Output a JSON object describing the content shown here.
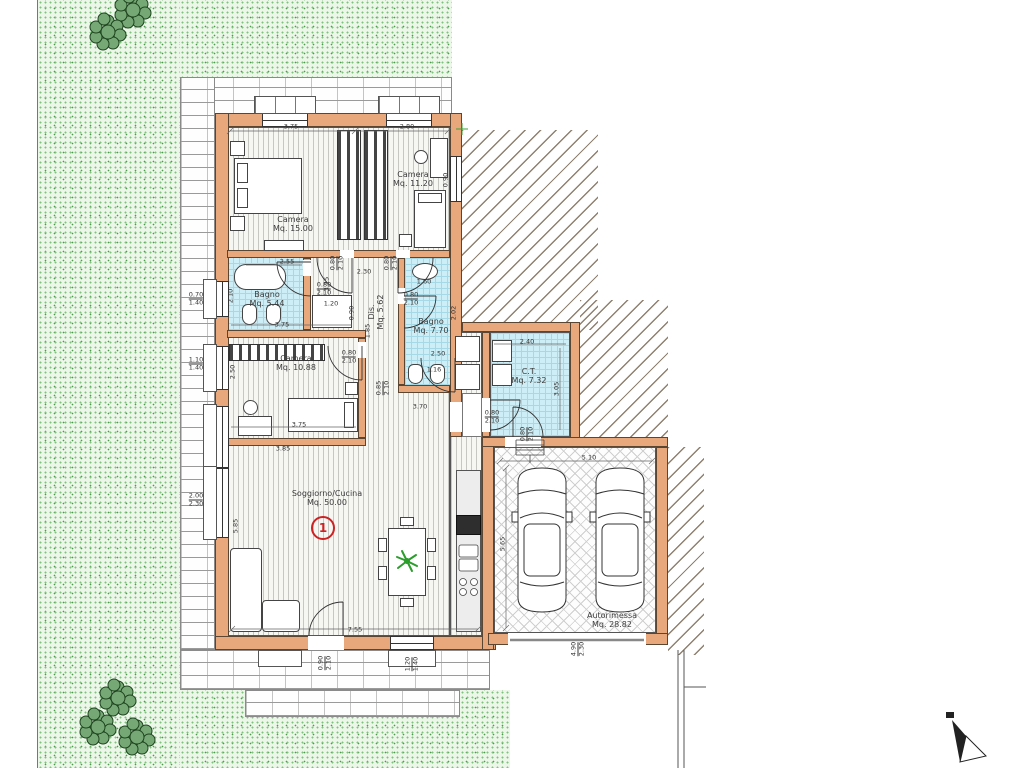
{
  "plan": {
    "unit_number": "1",
    "rooms": [
      {
        "id": "camera1",
        "label": "Camera",
        "area": "Mq. 15.00",
        "x": 293,
        "y": 224,
        "r": 0
      },
      {
        "id": "camera2",
        "label": "Camera",
        "area": "Mq. 11.20",
        "x": 413,
        "y": 179,
        "r": 0
      },
      {
        "id": "bagno1",
        "label": "Bagno",
        "area": "Mq. 5.44",
        "x": 267,
        "y": 299,
        "r": 0
      },
      {
        "id": "bagno2",
        "label": "Bagno",
        "area": "Mq. 7.70",
        "x": 431,
        "y": 326,
        "r": 0
      },
      {
        "id": "camera3",
        "label": "Camera",
        "area": "Mq. 10.88",
        "x": 296,
        "y": 363,
        "r": 0
      },
      {
        "id": "disimpegno",
        "label": "Dis.",
        "area": "Mq. 5.62",
        "x": 376,
        "y": 312,
        "r": -90
      },
      {
        "id": "soggiorno",
        "label": "Soggiorno/Cucina",
        "area": "Mq. 50.00",
        "x": 327,
        "y": 498,
        "r": 0
      },
      {
        "id": "ct",
        "label": "C.T.",
        "area": "Mq. 7.32",
        "x": 529,
        "y": 376,
        "r": 0
      },
      {
        "id": "autorimessa",
        "label": "Autorimessa",
        "area": "Mq. 28.82",
        "x": 612,
        "y": 620,
        "r": 0
      }
    ],
    "dimensions": [
      {
        "t": "3.75",
        "x": 291,
        "y": 127,
        "r": 0
      },
      {
        "t": "2.80",
        "x": 407,
        "y": 127,
        "r": 0
      },
      {
        "t": "0.90",
        "x": 446,
        "y": 180,
        "r": -90
      },
      {
        "a": "0.80",
        "b": "2.10",
        "x": 337,
        "y": 263,
        "r": -90
      },
      {
        "a": "0.80",
        "b": "2.10",
        "x": 391,
        "y": 263,
        "r": -90
      },
      {
        "t": "2.30",
        "x": 364,
        "y": 272,
        "r": 0
      },
      {
        "t": "2.55",
        "x": 287,
        "y": 262,
        "r": 0
      },
      {
        "a": "0.80",
        "b": "2.10",
        "x": 324,
        "y": 289,
        "r": 0
      },
      {
        "t": "2.10",
        "x": 231,
        "y": 296,
        "r": -90
      },
      {
        "a": "0.70",
        "b": "1.40",
        "x": 196,
        "y": 299,
        "r": 0
      },
      {
        "t": "3.15",
        "x": 327,
        "y": 284,
        "r": -90
      },
      {
        "t": "1.20",
        "x": 331,
        "y": 304,
        "r": 0
      },
      {
        "t": "0.90",
        "x": 352,
        "y": 313,
        "r": -90
      },
      {
        "t": "3.75",
        "x": 282,
        "y": 325,
        "r": 0
      },
      {
        "t": "1.60",
        "x": 424,
        "y": 282,
        "r": 0
      },
      {
        "a": "0.80",
        "b": "2.10",
        "x": 411,
        "y": 299,
        "r": 0
      },
      {
        "t": "2.02",
        "x": 454,
        "y": 313,
        "r": -90
      },
      {
        "t": "1.85",
        "x": 368,
        "y": 331,
        "r": -90
      },
      {
        "t": "2.50",
        "x": 438,
        "y": 354,
        "r": 0
      },
      {
        "a": "1.10",
        "b": "1.40",
        "x": 196,
        "y": 364,
        "r": 0
      },
      {
        "t": "2.50",
        "x": 233,
        "y": 372,
        "r": -90
      },
      {
        "a": "0.80",
        "b": "2.10",
        "x": 349,
        "y": 357,
        "r": 0
      },
      {
        "t": "1.16",
        "x": 434,
        "y": 370,
        "r": 0
      },
      {
        "a": "0.85",
        "b": "2.10",
        "x": 383,
        "y": 388,
        "r": -90
      },
      {
        "t": "3.70",
        "x": 420,
        "y": 407,
        "r": 0
      },
      {
        "t": "3.75",
        "x": 299,
        "y": 425,
        "r": 0
      },
      {
        "t": "3.85",
        "x": 283,
        "y": 449,
        "r": 0
      },
      {
        "t": "2.40",
        "x": 527,
        "y": 342,
        "r": 0
      },
      {
        "t": "3.05",
        "x": 557,
        "y": 389,
        "r": -90
      },
      {
        "a": "0.80",
        "b": "2.10",
        "x": 492,
        "y": 417,
        "r": 0
      },
      {
        "a": "0.80",
        "b": "2.10",
        "x": 527,
        "y": 434,
        "r": -90
      },
      {
        "a": "2.00",
        "b": "2.30",
        "x": 196,
        "y": 500,
        "r": 0
      },
      {
        "t": "5.85",
        "x": 236,
        "y": 526,
        "r": -90
      },
      {
        "t": "5.10",
        "x": 589,
        "y": 458,
        "r": 0
      },
      {
        "t": "5.65",
        "x": 503,
        "y": 544,
        "r": -90
      },
      {
        "t": "7.55",
        "x": 355,
        "y": 630,
        "r": 0
      },
      {
        "a": "0.90",
        "b": "2.10",
        "x": 325,
        "y": 663,
        "r": -90
      },
      {
        "a": "1.20",
        "b": "1.40",
        "x": 412,
        "y": 664,
        "r": -90
      },
      {
        "a": "4.90",
        "b": "2.30",
        "x": 578,
        "y": 649,
        "r": -90
      }
    ],
    "colors": {
      "wall": "#e8a87c",
      "bathroom_floor": "#cdeef6",
      "garden_green": "#7cc47c",
      "unit_badge": "#cc2222",
      "plant_green": "#2a9d2a"
    },
    "icons": [
      {
        "name": "north-arrow-icon"
      },
      {
        "name": "plant-icon"
      },
      {
        "name": "car-icon"
      },
      {
        "name": "survey-cross-icon"
      }
    ]
  }
}
